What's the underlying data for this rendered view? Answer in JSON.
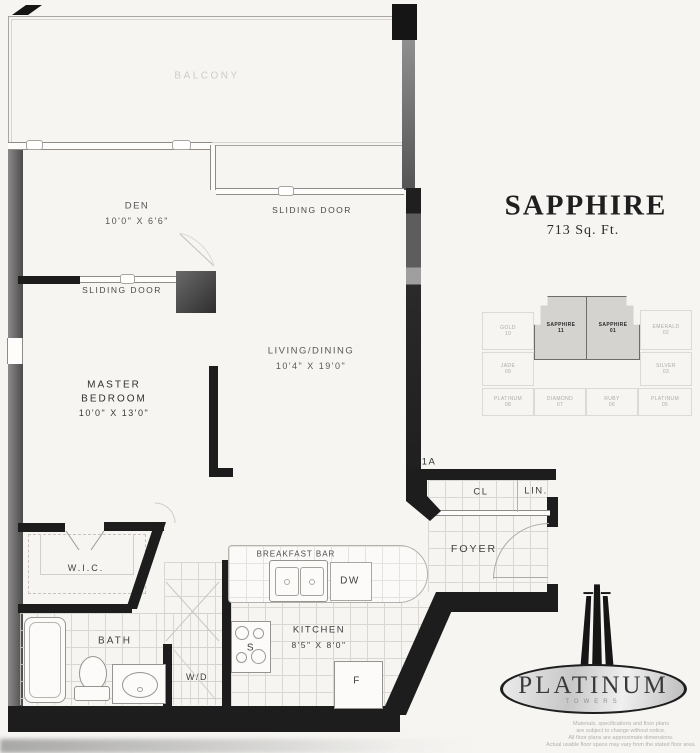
{
  "plan": {
    "unit_number": "1A",
    "labels": {
      "balcony": "BALCONY",
      "den": "DEN",
      "den_dims": "10'0\" X 6'6\"",
      "sliding_door_living": "SLIDING DOOR",
      "sliding_door_master": "SLIDING DOOR",
      "living": "LIVING/DINING",
      "living_dims": "10'4\" X 19'0\"",
      "master_line1": "MASTER",
      "master_line2": "BEDROOM",
      "master_dims": "10'0\" X 13'0\"",
      "wic": "W.I.C.",
      "bath": "BATH",
      "wd": "W/D",
      "breakfast_bar": "BREAKFAST BAR",
      "kitchen": "KITCHEN",
      "kitchen_dims": "8'5\" X 8'0\"",
      "stove": "S",
      "fridge": "F",
      "dishwasher": "DW",
      "closet": "CL",
      "linen": "LIN.",
      "foyer": "FOYER"
    }
  },
  "title": {
    "unit_name": "SAPPHIRE",
    "area": "713 Sq. Ft."
  },
  "keyplan": {
    "highlight_color": "#d4d3cf",
    "units": [
      {
        "name": "GOLD",
        "num": "10"
      },
      {
        "name": "SAPPHIRE",
        "num": "11"
      },
      {
        "name": "SAPPHIRE",
        "num": "01"
      },
      {
        "name": "EMERALD",
        "num": "02"
      },
      {
        "name": "JADE",
        "num": "09"
      },
      {
        "name": "SILVER",
        "num": "03"
      },
      {
        "name": "PLATINUM",
        "num": "08"
      },
      {
        "name": "DIAMOND",
        "num": "07"
      },
      {
        "name": "RUBY",
        "num": "06"
      },
      {
        "name": "PLATINUM",
        "num": "05"
      }
    ]
  },
  "logo": {
    "name": "PLATINUM",
    "subtitle": "TOWERS"
  },
  "disclaimer": [
    "Materials, specifications and floor plans",
    "are subject to change without notice.",
    "All floor plans are approximate dimensions.",
    "Actual usable floor space may vary from the stated floor area."
  ]
}
